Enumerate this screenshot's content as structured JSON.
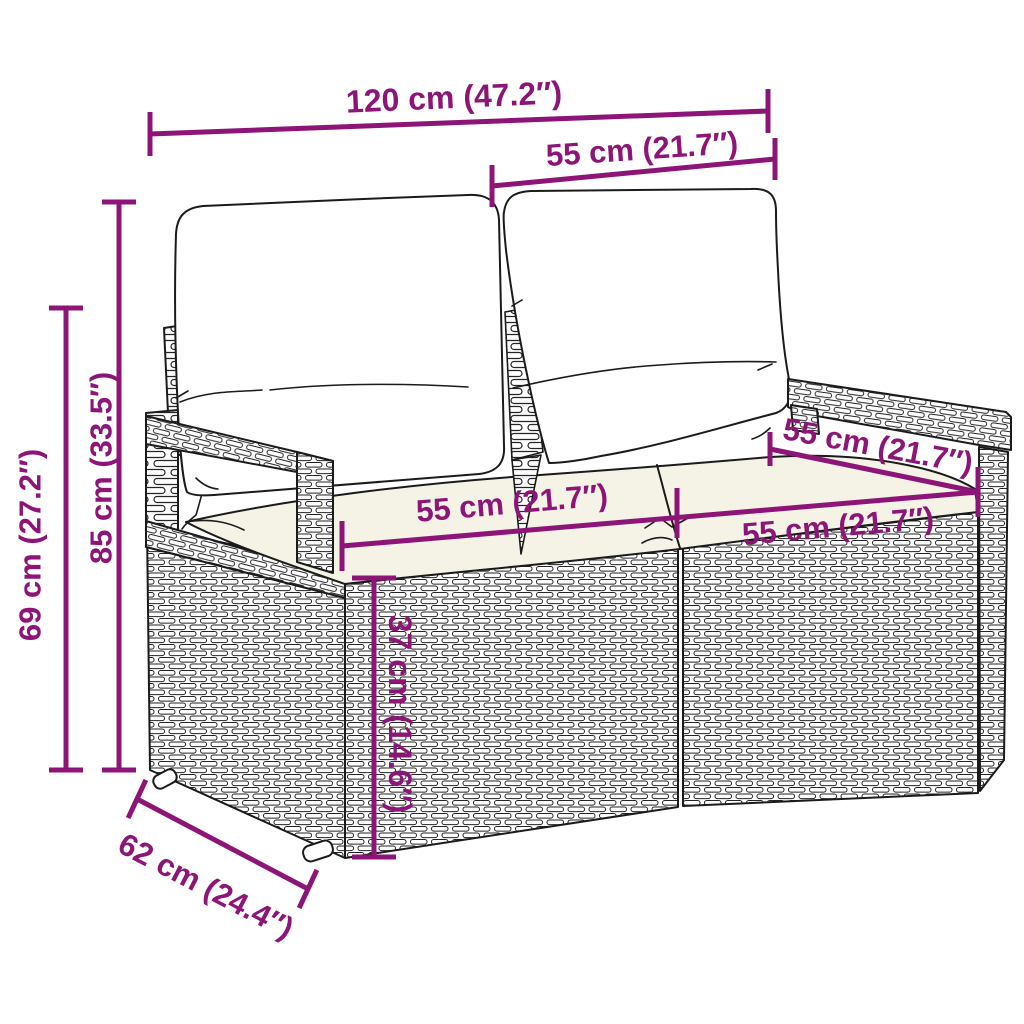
{
  "diagram": {
    "alt": "Line drawing of a poly rattan 2-seater garden sofa with back cushions and seat cushions, annotated with magenta dimension lines",
    "style": {
      "dimension_color": "#8C1577",
      "outline_color": "#1b1b1b",
      "background_color": "#ffffff",
      "seat_cushion_fill": "#f5f2e6"
    },
    "dimensions": {
      "total_width": "120 cm (47.2″)",
      "backrest_width": "55 cm (21.7″)",
      "total_height": "85 cm (33.5″)",
      "armrest_height": "69 cm (27.2″)",
      "seat_width_left": "55 cm (21.7″)",
      "seat_width_right": "55 cm (21.7″)",
      "backrest_top_width": "55 cm (21.7″)",
      "seat_height": "37 cm (14.6″)",
      "depth": "62 cm (24.4″)"
    }
  }
}
